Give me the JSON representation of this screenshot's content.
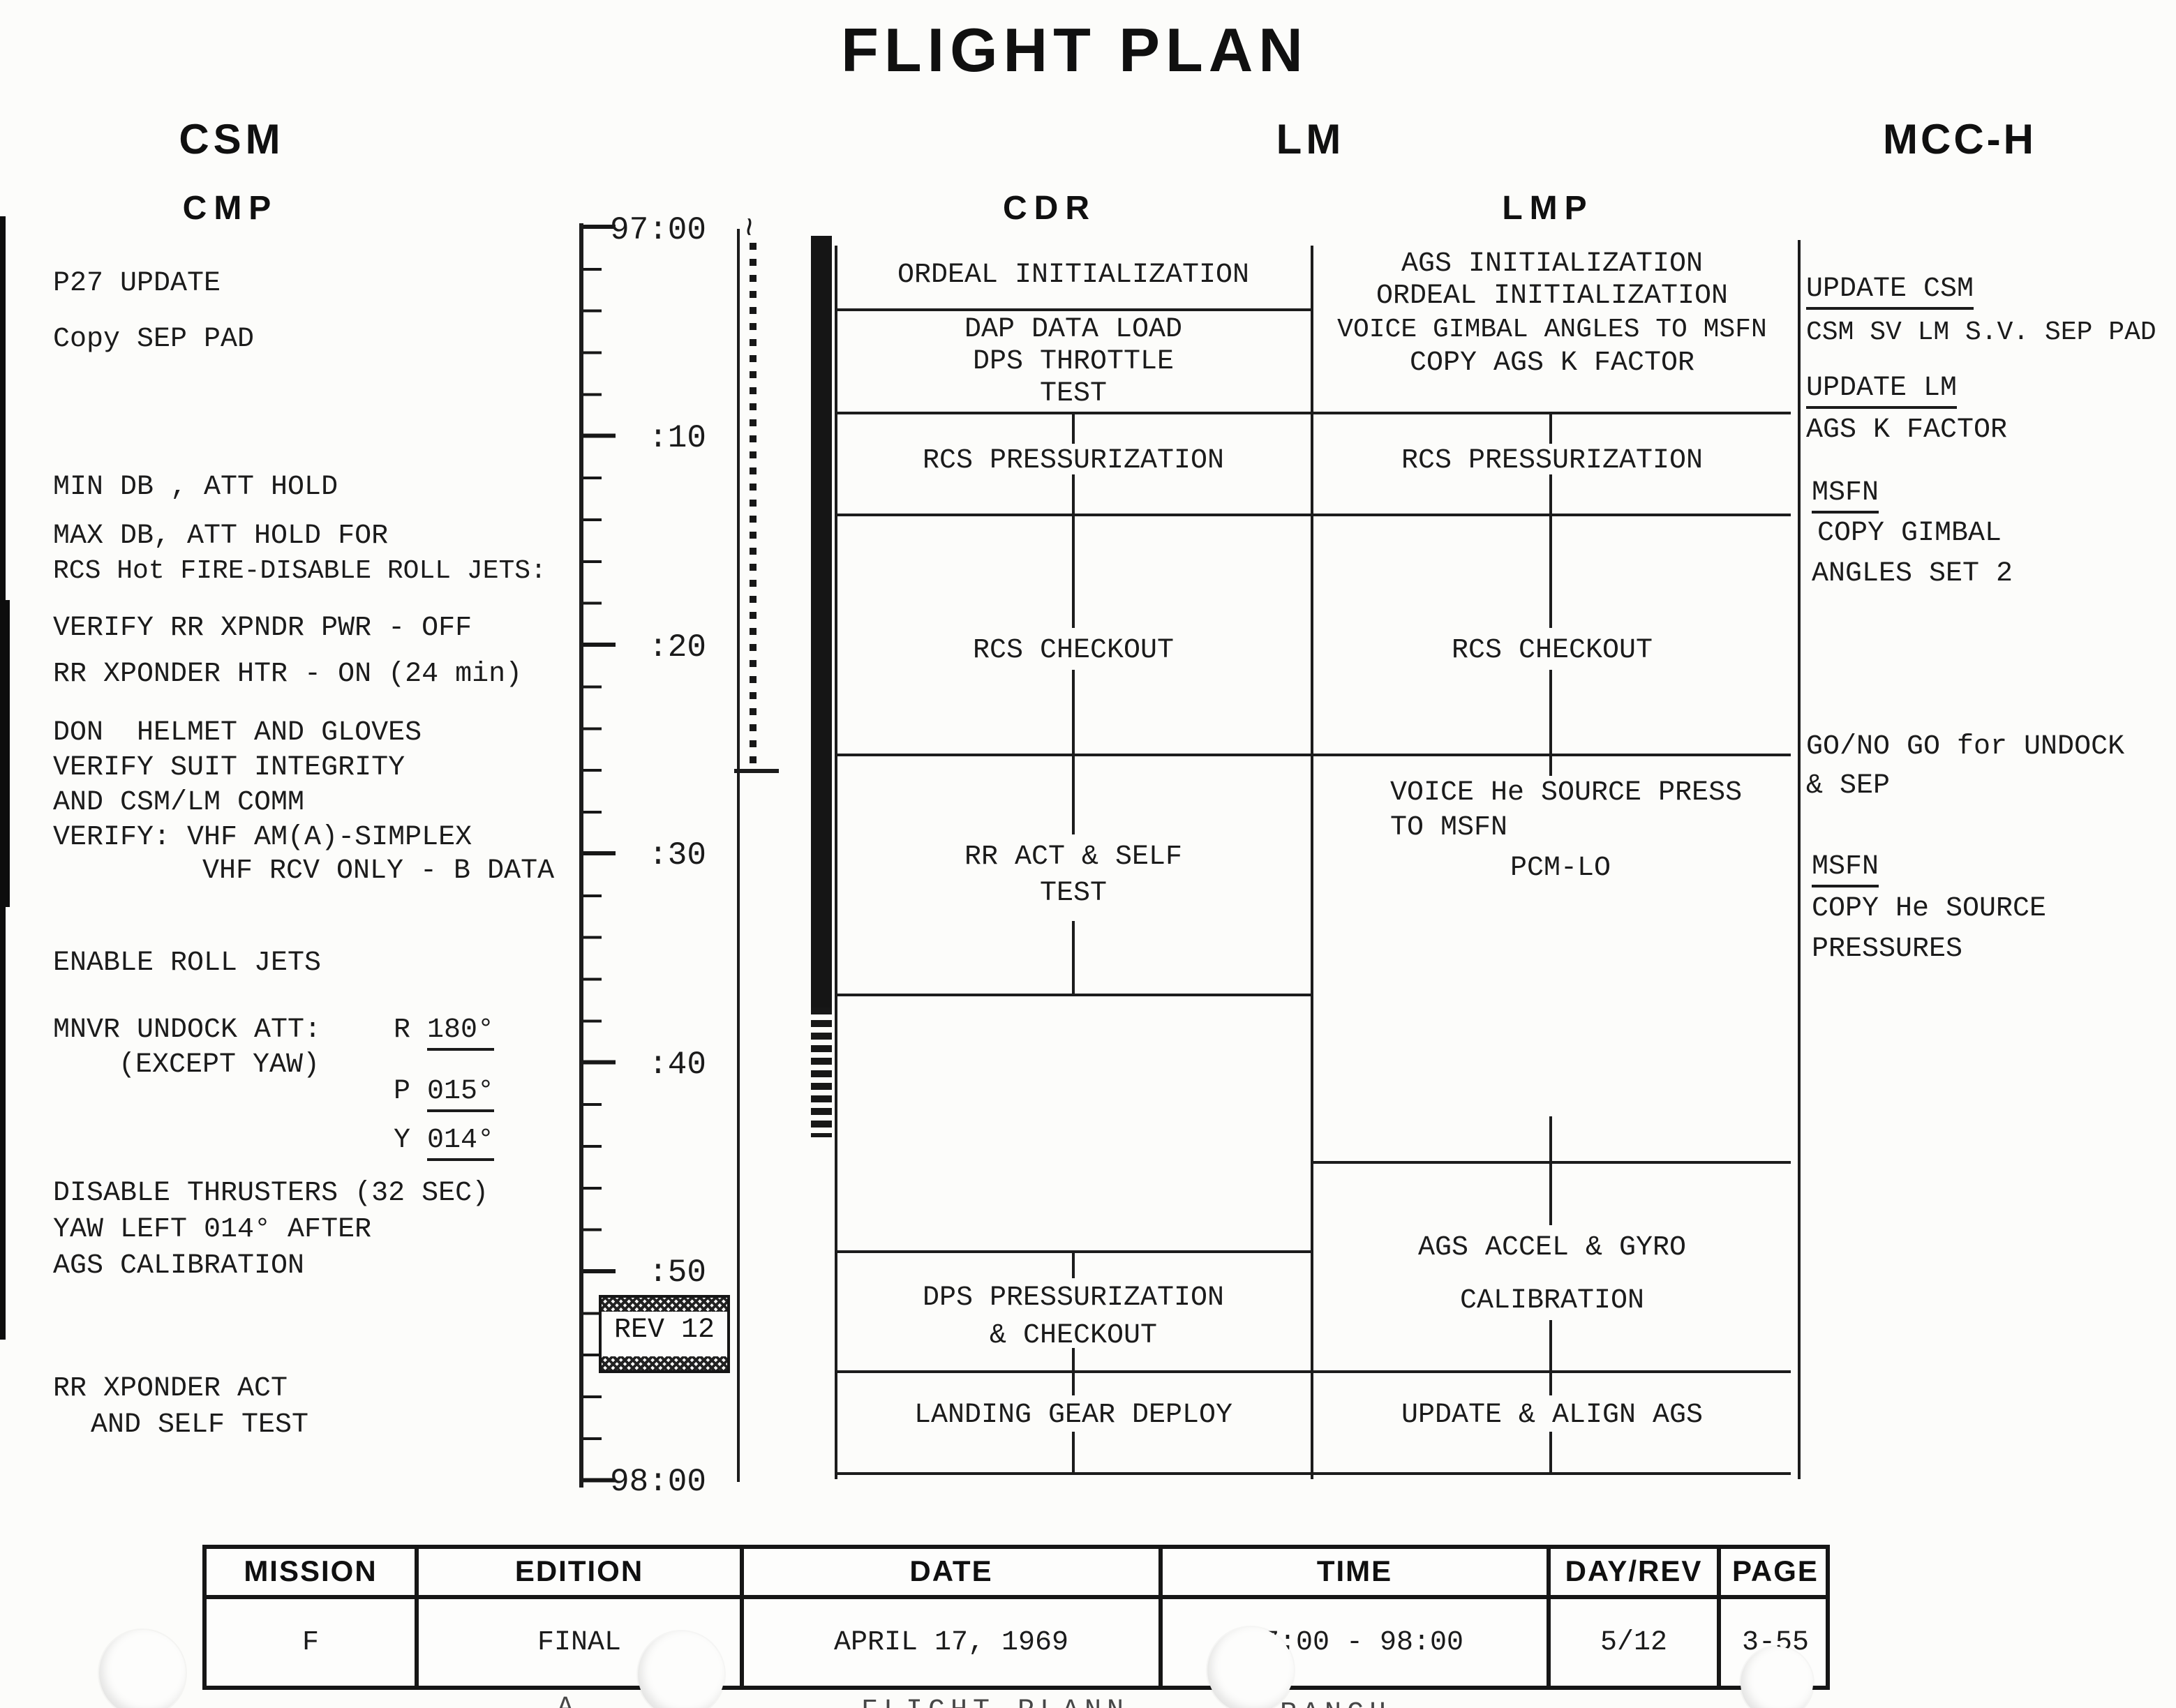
{
  "title": "FLIGHT PLAN",
  "columns": {
    "csm": "CSM",
    "lm": "LM",
    "mcch": "MCC-H",
    "cmp": "CMP",
    "cdr": "CDR",
    "lmp": "LMP"
  },
  "timeline": {
    "squiggle": "~",
    "labels": [
      "97:00",
      ":10",
      ":20",
      ":30",
      ":40",
      ":50",
      "98:00"
    ],
    "rev_badge": "REV 12"
  },
  "cmp": {
    "lines": [
      "P27 UPDATE",
      "Copy SEP PAD",
      "MIN DB , ATT HOLD",
      "MAX DB, ATT HOLD FOR",
      "RCS Hot FIRE-DISABLE ROLL JETS:",
      "VERIFY RR XPNDR PWR - OFF",
      "RR XPONDER HTR - ON (24 min)",
      "DON  HELMET AND GLOVES",
      "VERIFY SUIT INTEGRITY",
      "AND CSM/LM COMM",
      "VERIFY: VHF AM(A)-SIMPLEX",
      "VHF RCV ONLY - B DATA",
      "ENABLE ROLL JETS",
      "DISABLE THRUSTERS (32 SEC)",
      "YAW LEFT 014° AFTER",
      "AGS CALIBRATION",
      "RR XPONDER ACT",
      "AND SELF TEST"
    ],
    "mnvr": {
      "label": "MNVR UNDOCK ATT:",
      "except": "(EXCEPT YAW)",
      "r_label": "R ",
      "r_value": "180°",
      "p_label": "P ",
      "p_value": "015°",
      "y_label": "Y ",
      "y_value": "014°"
    }
  },
  "cdr": {
    "act1": "ORDEAL INITIALIZATION",
    "act2a": "DAP DATA LOAD",
    "act2b": "DPS THROTTLE",
    "act2c": "TEST",
    "act3": "RCS PRESSURIZATION",
    "act4": "RCS CHECKOUT",
    "act5a": "RR ACT & SELF",
    "act5b": "TEST",
    "act6a": "DPS PRESSURIZATION",
    "act6b": "& CHECKOUT",
    "act7": "LANDING GEAR DEPLOY"
  },
  "lmp": {
    "act1a": "AGS INITIALIZATION",
    "act1b": "ORDEAL INITIALIZATION",
    "act1c": "VOICE GIMBAL ANGLES TO MSFN",
    "act1d": "COPY AGS K FACTOR",
    "act2": "RCS PRESSURIZATION",
    "act3": "RCS CHECKOUT",
    "act4a": "VOICE He SOURCE PRESS",
    "act4b": "TO MSFN",
    "act4c": "PCM-LO",
    "act5a": "AGS ACCEL & GYRO",
    "act5b": "CALIBRATION",
    "act6": "UPDATE & ALIGN AGS"
  },
  "mcch": {
    "g1a": "UPDATE CSM",
    "g1b": "CSM SV LM S.V. SEP PAD",
    "g2a": "UPDATE LM",
    "g2b": "AGS K FACTOR",
    "g3a": "MSFN",
    "g3b": "COPY GIMBAL",
    "g3c": "ANGLES SET 2",
    "g4a": "GO/NO GO for UNDOCK",
    "g4b": "& SEP",
    "g5a": "MSFN",
    "g5b": "COPY He SOURCE",
    "g5c": "PRESSURES"
  },
  "table": {
    "headers": [
      "MISSION",
      "EDITION",
      "DATE",
      "TIME",
      "DAY/REV",
      "PAGE"
    ],
    "values": [
      "F",
      "FINAL",
      "APRIL 17, 1969",
      "97:00 - 98:00",
      "5/12",
      "3-55"
    ]
  },
  "footer": {
    "stray": "A",
    "left": "FLIGHT PLANN",
    "right": "BRANCH"
  }
}
